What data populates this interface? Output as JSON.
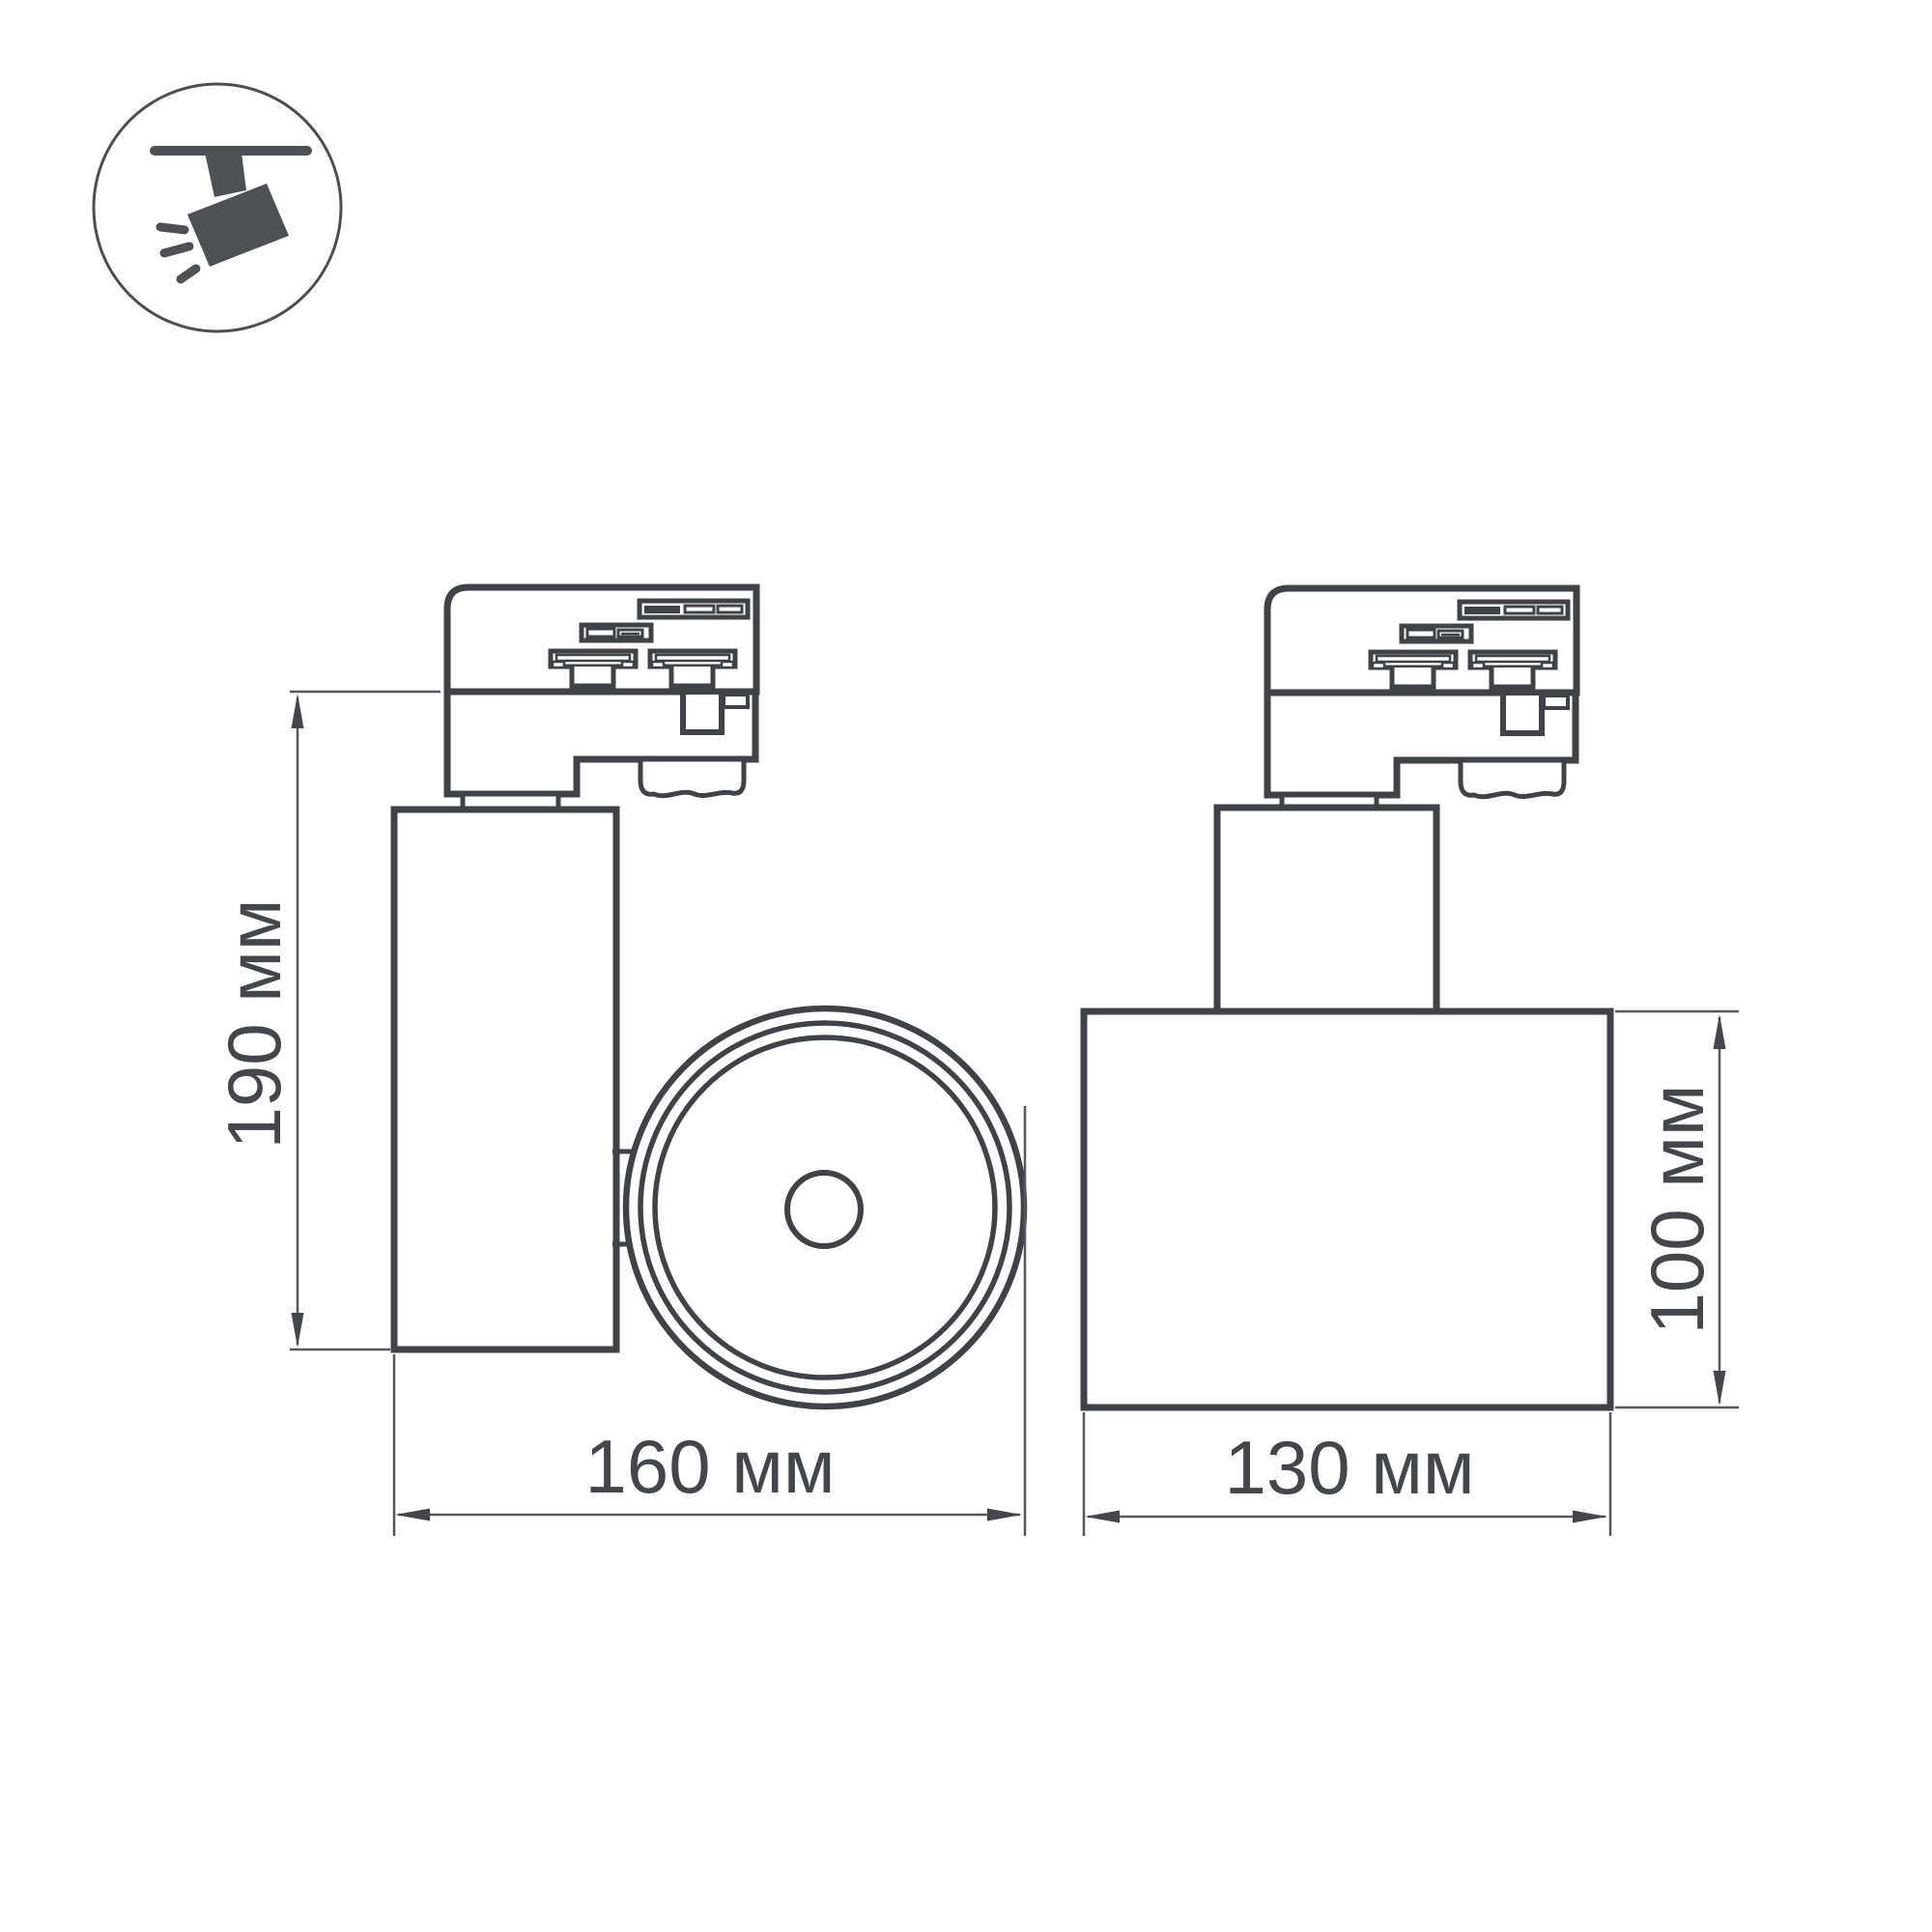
{
  "meta": {
    "description": "Technical dimension drawing of a 3-phase track-mounted LED spotlight, two projections",
    "background": "#ffffff"
  },
  "icon": {
    "name": "track-spotlight-icon",
    "color": "#4d5156",
    "circle_color": "#4b4f54"
  },
  "drawing": {
    "stroke_color": "#3f4347",
    "thin_line_color": "#55585c",
    "text_color": "#43474b",
    "fill_color": "#ffffff",
    "dark_detail_color": "#3f4347"
  },
  "dimensions": {
    "fixture_height": {
      "label": "190 мм",
      "value_mm": 190
    },
    "fixture_width": {
      "label": "160 мм",
      "value_mm": 160
    },
    "body_width": {
      "label": "130 мм",
      "value_mm": 130
    },
    "body_height": {
      "label": "100 мм",
      "value_mm": 100
    }
  }
}
